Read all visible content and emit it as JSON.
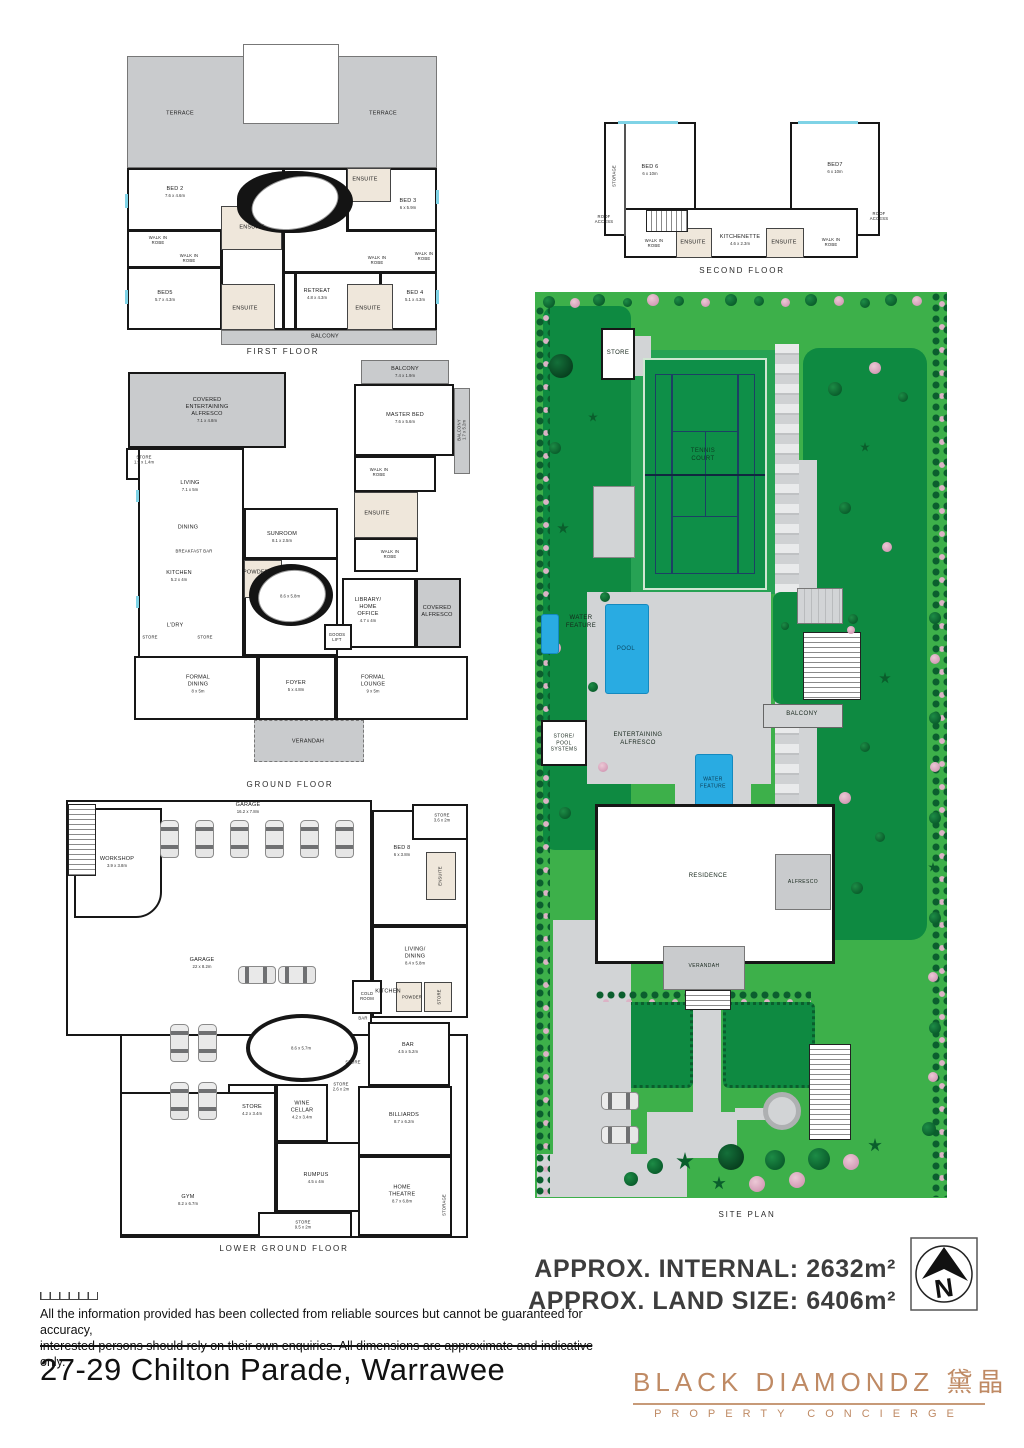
{
  "colors": {
    "wall": "#1a1a1a",
    "terrace_grey": "#c9cbcd",
    "ensuite_beige": "#efe7db",
    "window_cyan": "#7fd3e6",
    "site_green": "#3db04a",
    "lawn_green": "#0e8a41",
    "path_grey": "#d2d4d6",
    "pool_blue": "#29abe2",
    "brand_copper": "#bf8a64"
  },
  "floors": {
    "first": {
      "title": "FIRST FLOOR",
      "rooms": [
        {
          "label": "TERRACE",
          "dims": ""
        },
        {
          "label": "TERRACE",
          "dims": ""
        },
        {
          "label": "BED 2",
          "dims": "7.6 x 4.6m"
        },
        {
          "label": "ENSUITE",
          "dims": ""
        },
        {
          "label": "WALK IN ROBE",
          "dims": ""
        },
        {
          "label": "WALK IN ROBE",
          "dims": ""
        },
        {
          "label": "BED5",
          "dims": "5.7 x 4.3m"
        },
        {
          "label": "ENSUITE",
          "dims": ""
        },
        {
          "label": "RETREAT",
          "dims": "4.8 x 4.3m"
        },
        {
          "label": "ENSUITE",
          "dims": ""
        },
        {
          "label": "ENSUITE",
          "dims": ""
        },
        {
          "label": "BED 3",
          "dims": "6 x 5.9m"
        },
        {
          "label": "WALK IN ROBE",
          "dims": ""
        },
        {
          "label": "WALK IN ROBE",
          "dims": ""
        },
        {
          "label": "BED 4",
          "dims": "5.1 x 4.3m"
        },
        {
          "label": "BALCONY",
          "dims": ""
        }
      ]
    },
    "second": {
      "title": "SECOND FLOOR",
      "rooms": [
        {
          "label": "STORAGE",
          "dims": ""
        },
        {
          "label": "BED 6",
          "dims": "6 x 10m"
        },
        {
          "label": "BED7",
          "dims": "6 x 10m"
        },
        {
          "label": "ROOF ACCESS",
          "dims": ""
        },
        {
          "label": "ROOF ACCESS",
          "dims": ""
        },
        {
          "label": "WALK IN ROBE",
          "dims": ""
        },
        {
          "label": "ENSUITE",
          "dims": ""
        },
        {
          "label": "KITCHENETTE",
          "dims": "4.6 x 2.3m"
        },
        {
          "label": "ENSUITE",
          "dims": ""
        },
        {
          "label": "WALK IN ROBE",
          "dims": ""
        }
      ]
    },
    "ground": {
      "title": "GROUND FLOOR",
      "rooms": [
        {
          "label": "COVERED ENTERTAINING ALFRESCO",
          "dims": "7.1 x 4.8m"
        },
        {
          "label": "STORE",
          "dims": "1.9 x 1.4m"
        },
        {
          "label": "LIVING",
          "dims": "7.1 x 5m"
        },
        {
          "label": "DINING",
          "dims": ""
        },
        {
          "label": "BREAKFAST BAR",
          "dims": ""
        },
        {
          "label": "KITCHEN",
          "dims": "5.2 x 4m"
        },
        {
          "label": "L'DRY",
          "dims": ""
        },
        {
          "label": "STORE",
          "dims": ""
        },
        {
          "label": "STORE",
          "dims": ""
        },
        {
          "label": "SUNROOM",
          "dims": "8.1 x 2.5m"
        },
        {
          "label": "POWDER",
          "dims": ""
        },
        {
          "label": "BALCONY",
          "dims": "7.4 x 1.9m"
        },
        {
          "label": "MASTER BED",
          "dims": "7.6 x 5.6m"
        },
        {
          "label": "BALCONY",
          "dims": "1.7 x 5.2m"
        },
        {
          "label": "WALK IN ROBE",
          "dims": ""
        },
        {
          "label": "ENSUITE",
          "dims": ""
        },
        {
          "label": "WALK IN ROBE",
          "dims": ""
        },
        {
          "label": "LIBRARY/ HOME OFFICE",
          "dims": "4.7 x 4m"
        },
        {
          "label": "COVERED ALFRESCO",
          "dims": ""
        },
        {
          "label": "GOODS LIFT",
          "dims": ""
        },
        {
          "label": "FORMAL DINING",
          "dims": "8 x 5m"
        },
        {
          "label": "FOYER",
          "dims": "5 x 4.8m"
        },
        {
          "label": "FORMAL LOUNGE",
          "dims": "9 x 5m"
        },
        {
          "label": "VERANDAH",
          "dims": ""
        },
        {
          "label": "",
          "dims": "8.6 x 5.8m"
        }
      ]
    },
    "lower": {
      "title": "LOWER GROUND FLOOR",
      "rooms": [
        {
          "label": "WORKSHOP",
          "dims": "3.9 x 3.8m"
        },
        {
          "label": "GARAGE",
          "dims": "16.2 x 7.8m"
        },
        {
          "label": "GARAGE",
          "dims": "22 x 8.2m"
        },
        {
          "label": "STORE",
          "dims": "3.6 x 2m"
        },
        {
          "label": "BED 8",
          "dims": "6 x 3.8m"
        },
        {
          "label": "ENSUITE",
          "dims": ""
        },
        {
          "label": "LIVING/ DINING",
          "dims": "8.4 x 5.8m"
        },
        {
          "label": "KITCHEN",
          "dims": ""
        },
        {
          "label": "COLD ROOM",
          "dims": ""
        },
        {
          "label": "BAR",
          "dims": ""
        },
        {
          "label": "STORE",
          "dims": ""
        },
        {
          "label": "POWDER",
          "dims": ""
        },
        {
          "label": "BAR",
          "dims": "4.5 x 5.2m"
        },
        {
          "label": "STORE",
          "dims": ""
        },
        {
          "label": "STORE",
          "dims": "2.6 x 2m"
        },
        {
          "label": "WINE CELLAR",
          "dims": "4.2 x 3.4m"
        },
        {
          "label": "STORE",
          "dims": "4.2 x 3.4m"
        },
        {
          "label": "BILLIARDS",
          "dims": "8.7 x 6.2m"
        },
        {
          "label": "RUMPUS",
          "dims": "4.5 x 4m"
        },
        {
          "label": "HOME THEATRE",
          "dims": "8.7 x 6.8m"
        },
        {
          "label": "GYM",
          "dims": "8.2 x 6.7m"
        },
        {
          "label": "STORE",
          "dims": "9.5 x 2m"
        },
        {
          "label": "STORAGE",
          "dims": ""
        },
        {
          "label": "",
          "dims": "8.6 x 5.7m"
        }
      ]
    }
  },
  "site": {
    "title": "SITE PLAN",
    "labels": [
      {
        "label": "STORE"
      },
      {
        "label": "TENNIS COURT"
      },
      {
        "label": "WATER FEATURE"
      },
      {
        "label": "POOL"
      },
      {
        "label": "STORE/ POOL SYSTEMS"
      },
      {
        "label": "ENTERTAINING ALFRESCO"
      },
      {
        "label": "BALCONY"
      },
      {
        "label": "WATER FEATURE"
      },
      {
        "label": "RESIDENCE"
      },
      {
        "label": "ALFRESCO"
      },
      {
        "label": "VERANDAH"
      }
    ]
  },
  "footer": {
    "approx_internal": "APPROX. INTERNAL: 2632m²",
    "approx_land": "APPROX. LAND SIZE: 6406m²",
    "compass_n": "N",
    "disclaimer_line1": "All the information provided has been collected from reliable sources but cannot be guaranteed for accuracy,",
    "disclaimer_line2": "interested persons should rely on their own enquiries. All dimensions are approximate and indicative only.",
    "address": "27-29 Chilton Parade, Warrawee",
    "brand_name": "BLACK DIAMONDZ 黛晶",
    "brand_tagline": "PROPERTY CONCIERGE"
  }
}
